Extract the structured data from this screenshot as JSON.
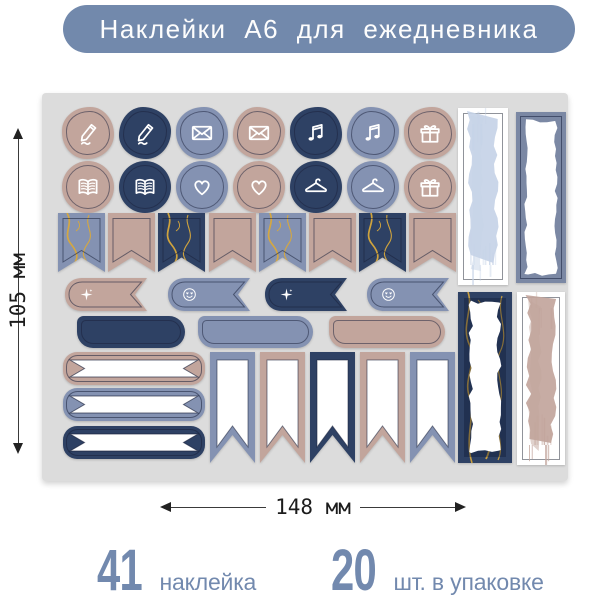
{
  "header": {
    "title": "Наклейки А6 для ежедневника"
  },
  "dimensions": {
    "height": "105 мм",
    "width": "148 мм"
  },
  "stats": [
    {
      "number": "41",
      "label": "наклейка"
    },
    {
      "number": "20",
      "label": "шт. в упаковке"
    }
  ],
  "colors": {
    "accent": "#7289ac",
    "accent_text": "#fdfdfd",
    "page_bg": "#ffffff",
    "sheet_bg": "#dcdcdc",
    "tan": "#c2a59c",
    "navy": "#2e4164",
    "blue": "#8492b2",
    "light_blue": "#c6d3e7",
    "panel_frame": "#7b88a4",
    "gold": "#d9a93c",
    "white": "#ffffff",
    "stats_text": "#7289ae",
    "dim_text": "#1c1c1c"
  },
  "sheet": {
    "circle_rows": [
      {
        "stickers": [
          {
            "icon": "pencil-icon",
            "color": "tan"
          },
          {
            "icon": "pencil-icon",
            "color": "navy"
          },
          {
            "icon": "envelope-icon",
            "color": "blue"
          },
          {
            "icon": "envelope-icon",
            "color": "tan"
          },
          {
            "icon": "music-icon",
            "color": "navy"
          },
          {
            "icon": "music-icon",
            "color": "blue"
          },
          {
            "icon": "gift-icon",
            "color": "tan"
          }
        ]
      },
      {
        "stickers": [
          {
            "icon": "book-icon",
            "color": "tan"
          },
          {
            "icon": "book-icon",
            "color": "navy"
          },
          {
            "icon": "heart-icon",
            "color": "blue"
          },
          {
            "icon": "heart-icon",
            "color": "tan"
          },
          {
            "icon": "hanger-icon",
            "color": "navy"
          },
          {
            "icon": "hanger-icon",
            "color": "blue"
          },
          {
            "icon": "gift-icon",
            "color": "tan"
          }
        ]
      }
    ],
    "flag_row": [
      {
        "color": "blue",
        "marble": true
      },
      {
        "color": "tan",
        "marble": false
      },
      {
        "color": "navy",
        "marble": true
      },
      {
        "color": "tan",
        "marble": false
      },
      {
        "color": "blue",
        "marble": true
      },
      {
        "color": "tan",
        "marble": false
      },
      {
        "color": "navy",
        "marble": true
      },
      {
        "color": "tan",
        "marble": false
      }
    ],
    "ribbon_row": [
      {
        "color": "tan",
        "icon": "sparkle-icon"
      },
      {
        "color": "blue",
        "icon": "smiley-icon"
      },
      {
        "color": "navy",
        "icon": "sparkle-icon"
      },
      {
        "color": "blue",
        "icon": "smiley-icon"
      }
    ],
    "tag_row": [
      {
        "color": "navy"
      },
      {
        "color": "blue"
      },
      {
        "color": "tan"
      }
    ],
    "banner_rows": [
      {
        "color": "tan"
      },
      {
        "color": "blue"
      },
      {
        "color": "navy"
      }
    ],
    "pennant_row": [
      {
        "color": "blue"
      },
      {
        "color": "tan"
      },
      {
        "color": "navy"
      },
      {
        "color": "tan"
      },
      {
        "color": "blue"
      }
    ],
    "panels": [
      {
        "style": "brush",
        "color": "light_blue"
      },
      {
        "style": "frame",
        "color": "panel_frame"
      },
      {
        "style": "marble",
        "color": "navy"
      },
      {
        "style": "brush",
        "color": "tan"
      }
    ]
  }
}
